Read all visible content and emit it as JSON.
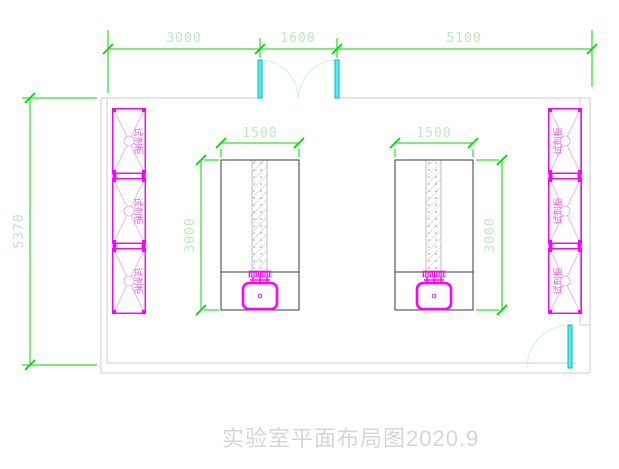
{
  "drawing": {
    "title": "实验室平面布局图2020.9"
  },
  "dimensions": {
    "top_left": "3000",
    "top_middle": "1600",
    "top_right": "5100",
    "left_height": "5370",
    "bench_width": "1500",
    "bench_depth": "3000"
  },
  "labels": {
    "reagent_cabinet": "试剂柜"
  },
  "colors": {
    "dimension_line": "#00d800",
    "dimension_text": "#bfe9bf",
    "cabinet_magenta": "#ff00ff",
    "door_cyan": "#00dddd",
    "wall_gray": "#cccccc",
    "bench_outline": "#3a3a3a",
    "title_text": "#d6d6d6"
  }
}
